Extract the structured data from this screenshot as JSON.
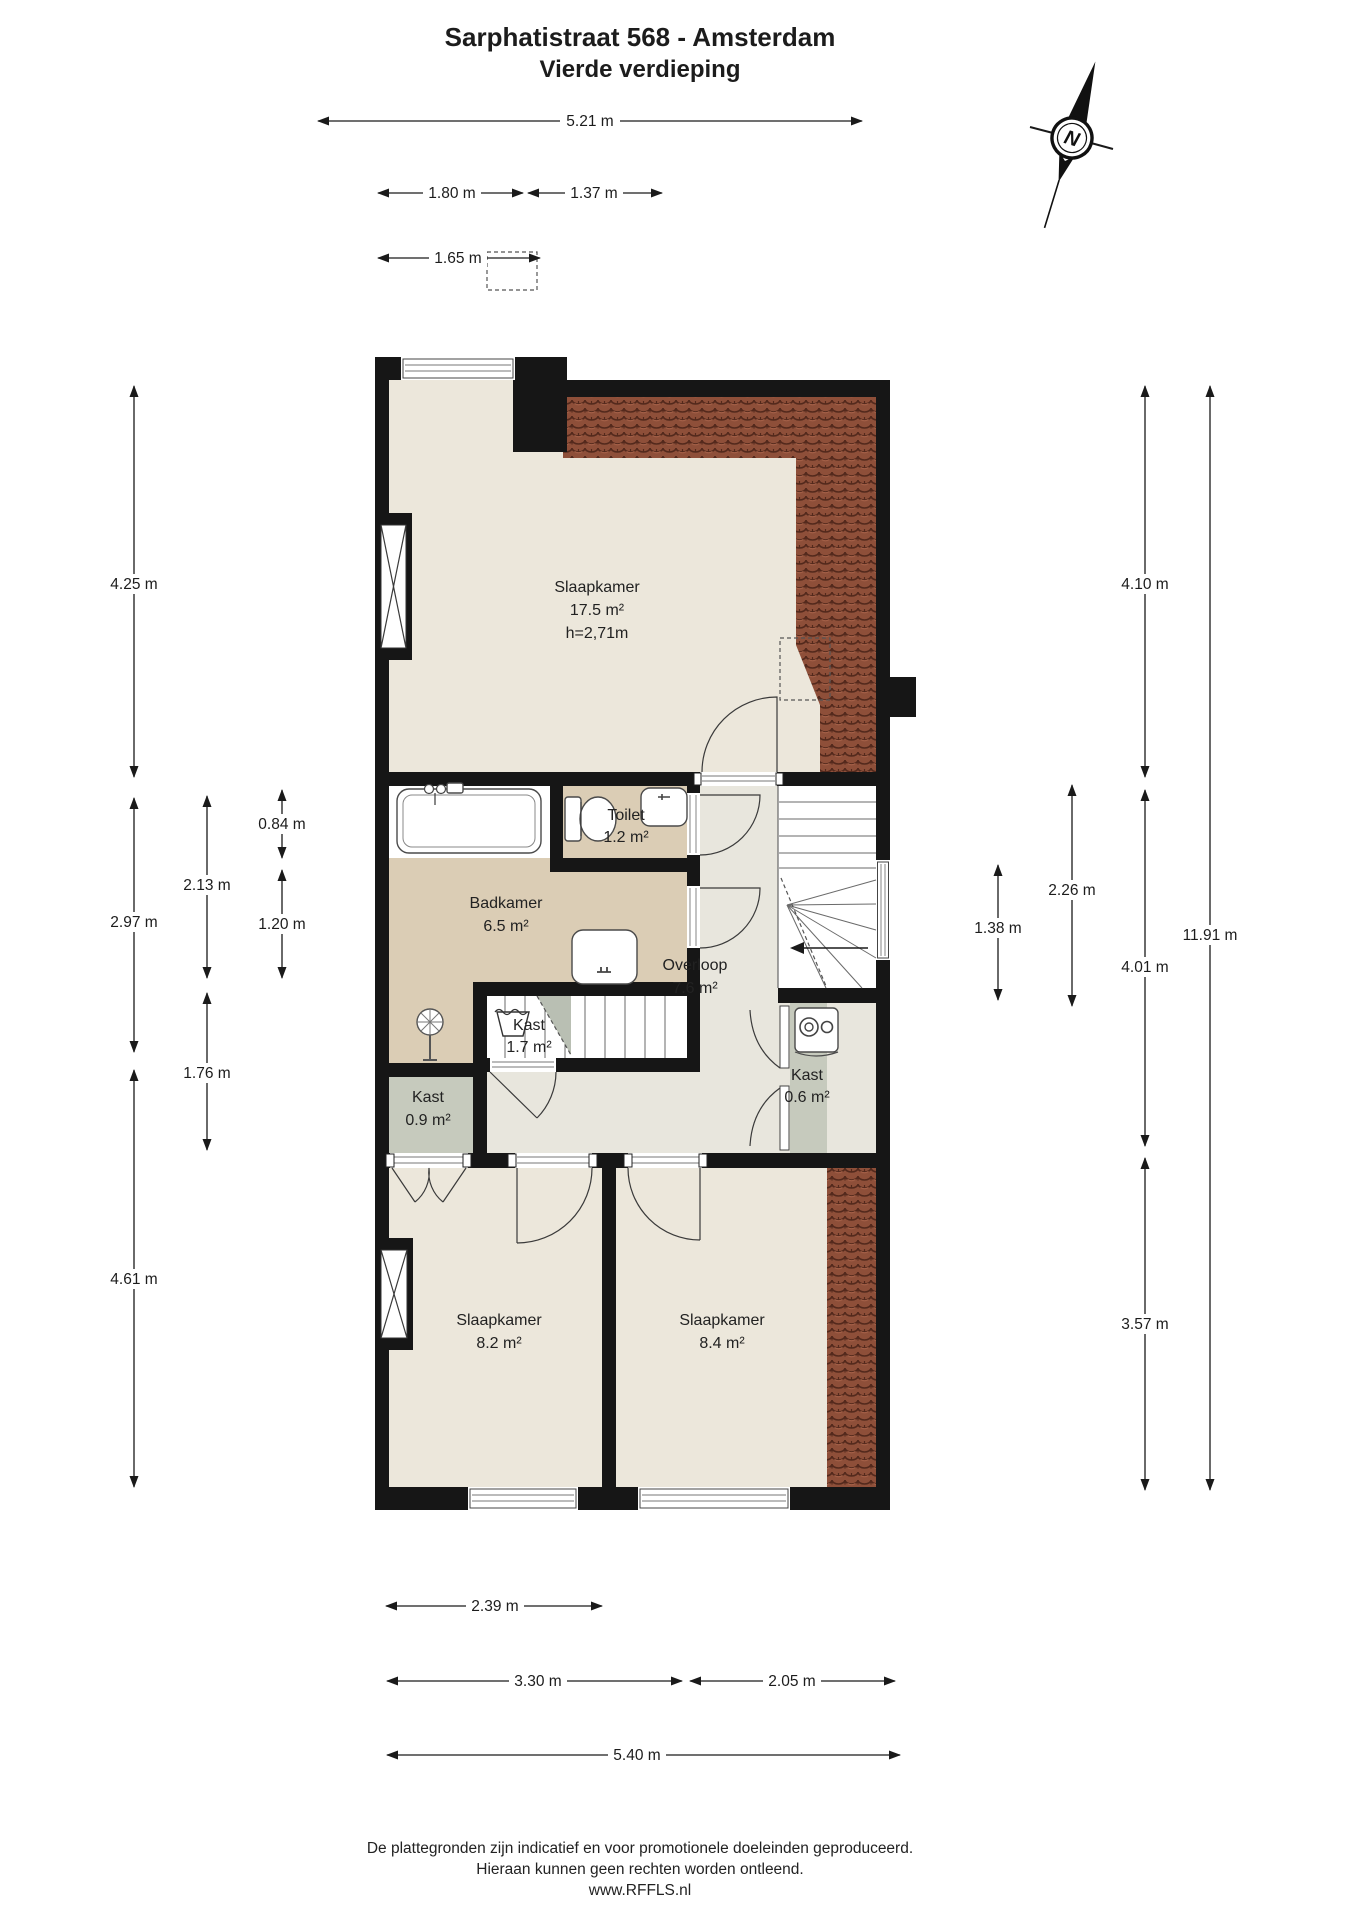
{
  "title": {
    "line1": "Sarphatistraat 568 - Amsterdam",
    "line2": "Vierde verdieping"
  },
  "compass": {
    "label": "N"
  },
  "rooms": {
    "slaapkamer1": {
      "name": "Slaapkamer",
      "area": "17.5 m²",
      "ceiling": "h=2,71m"
    },
    "toilet": {
      "name": "Toilet",
      "area": "1.2 m²"
    },
    "badkamer": {
      "name": "Badkamer",
      "area": "6.5 m²"
    },
    "overloop": {
      "name": "Overloop",
      "area": "7.6 m²"
    },
    "kast1": {
      "name": "Kast",
      "area": "1.7 m²"
    },
    "kast2": {
      "name": "Kast",
      "area": "0.9 m²"
    },
    "kast3": {
      "name": "Kast",
      "area": "0.6 m²"
    },
    "slaapkamer2": {
      "name": "Slaapkamer",
      "area": "8.2 m²"
    },
    "slaapkamer3": {
      "name": "Slaapkamer",
      "area": "8.4 m²"
    }
  },
  "dimensions": {
    "top": [
      "5.21 m",
      "1.80 m",
      "1.37 m",
      "1.65 m"
    ],
    "left": [
      "4.25 m",
      "2.97 m",
      "4.61 m",
      "2.13 m",
      "1.76 m",
      "0.84 m",
      "1.20 m"
    ],
    "right": [
      "4.10 m",
      "4.01 m",
      "3.57 m",
      "11.91 m",
      "1.38 m",
      "2.26 m"
    ],
    "bottom": [
      "2.39 m",
      "3.30 m",
      "2.05 m",
      "5.40 m"
    ]
  },
  "footer": {
    "line1": "De plattegronden zijn indicatief en voor promotionele doeleinden geproduceerd.",
    "line2": "Hieraan kunnen geen rechten worden ontleend.",
    "line3": "www.RFFLS.nl"
  },
  "colors": {
    "wall": "#161616",
    "floor_cream": "#ece7db",
    "floor_hall": "#e8e6dd",
    "floor_bath": "#dbcdb5",
    "floor_closet": "#c6cabd",
    "roof_tiles": "#8e4f39",
    "background": "#ffffff"
  }
}
